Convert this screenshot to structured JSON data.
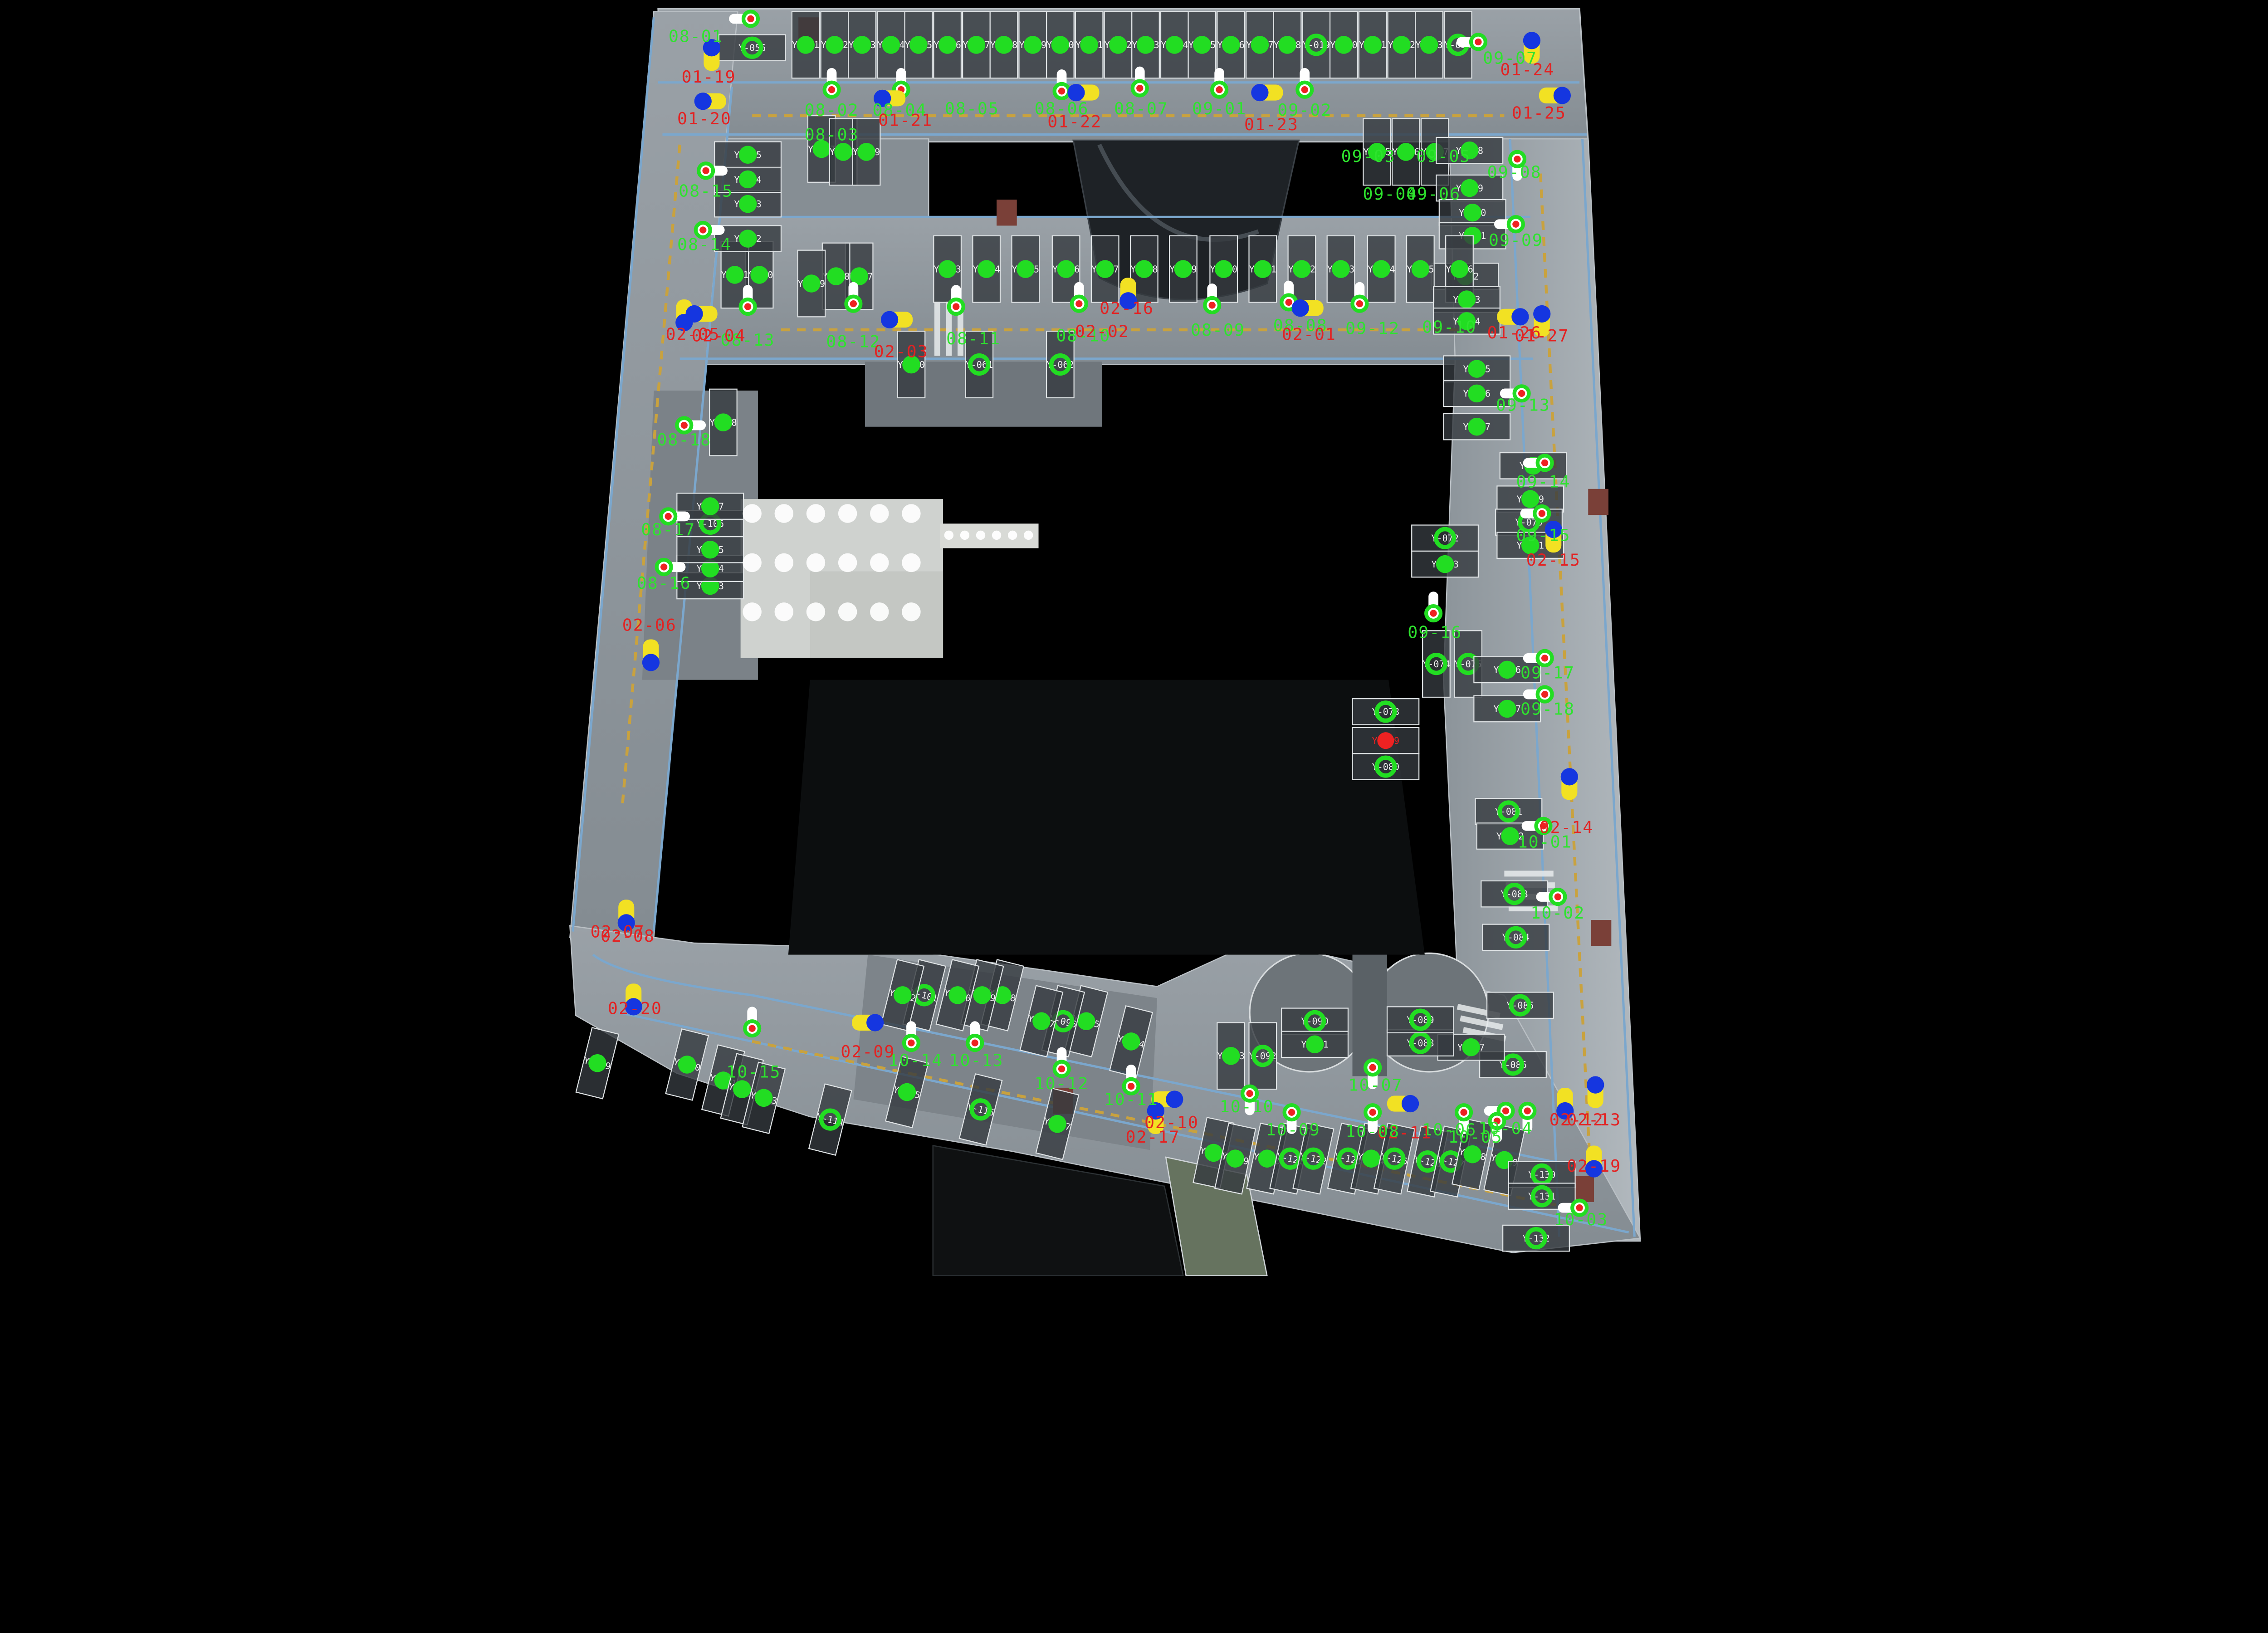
{
  "meta": {
    "view": "parking-garage-pointcloud-floorplan",
    "background": "#000000"
  },
  "colors": {
    "floor": "#8d959b",
    "floor_light": "#b5bcc1",
    "stall_fill": "#343a3f",
    "stall_stroke": "#dfe3e5",
    "corridor_line": "#7ba7cd",
    "lane_dash": "#c9a23e",
    "vacant_marker": "#22dd22",
    "occupied_marker": "#ee2222",
    "camera_ring": "#22dd22",
    "camera_center": "#ee2222",
    "camera_body": "#ffffff",
    "vehicle_yellow": "#f2e123",
    "vehicle_blue": "#1536e0",
    "zone_green": "#2ee32e",
    "zone_red": "#e32222",
    "stall_text": "#f2f2f2",
    "lobby": "#cfd2cf",
    "ramp_green": "#6d7a68",
    "patch_red": "#7a4038"
  },
  "zone_labels": [
    [
      "08-01",
      481,
      29,
      "g"
    ],
    [
      "01-19",
      490,
      57,
      "r"
    ],
    [
      "01-20",
      487,
      86,
      "r"
    ],
    [
      "08-02",
      575,
      80,
      "g"
    ],
    [
      "08-03",
      575,
      97,
      "g"
    ],
    [
      "08-04",
      622,
      80,
      "g"
    ],
    [
      "01-21",
      626,
      87,
      "r"
    ],
    [
      "08-05",
      672,
      79,
      "g"
    ],
    [
      "08-06",
      734,
      79,
      "g"
    ],
    [
      "01-22",
      743,
      88,
      "r"
    ],
    [
      "08-07",
      789,
      79,
      "g"
    ],
    [
      "09-01",
      843,
      79,
      "g"
    ],
    [
      "01-23",
      879,
      90,
      "r"
    ],
    [
      "09-02",
      902,
      80,
      "g"
    ],
    [
      "09-03",
      946,
      112,
      "g"
    ],
    [
      "09-05",
      998,
      112,
      "g"
    ],
    [
      "09-04",
      961,
      138,
      "g"
    ],
    [
      "09-06",
      991,
      138,
      "g"
    ],
    [
      "09-07",
      1044,
      44,
      "g"
    ],
    [
      "01-24",
      1056,
      52,
      "r"
    ],
    [
      "01-25",
      1064,
      82,
      "r"
    ],
    [
      "09-08",
      1047,
      123,
      "g"
    ],
    [
      "09-09",
      1048,
      170,
      "g"
    ],
    [
      "01-26",
      1047,
      234,
      "r"
    ],
    [
      "01-27",
      1066,
      236,
      "r"
    ],
    [
      "09-10",
      1002,
      230,
      "g"
    ],
    [
      "09-12",
      949,
      231,
      "g"
    ],
    [
      "09-13",
      1053,
      284,
      "g"
    ],
    [
      "09-14",
      1067,
      337,
      "g"
    ],
    [
      "09-15",
      1067,
      374,
      "g"
    ],
    [
      "02-15",
      1074,
      391,
      "r"
    ],
    [
      "09-16",
      992,
      441,
      "g"
    ],
    [
      "09-17",
      1070,
      469,
      "g"
    ],
    [
      "09-18",
      1070,
      494,
      "g"
    ],
    [
      "02-14",
      1083,
      576,
      "r"
    ],
    [
      "10-01",
      1068,
      586,
      "g"
    ],
    [
      "10-02",
      1077,
      635,
      "g"
    ],
    [
      "02-12",
      1090,
      778,
      "r"
    ],
    [
      "02-13",
      1102,
      778,
      "r"
    ],
    [
      "02-19",
      1102,
      810,
      "r"
    ],
    [
      "10-03",
      1093,
      847,
      "g"
    ],
    [
      "10-04",
      1041,
      784,
      "g"
    ],
    [
      "10-05",
      1020,
      790,
      "g"
    ],
    [
      "10-06",
      1002,
      785,
      "g"
    ],
    [
      "02-11",
      971,
      787,
      "r"
    ],
    [
      "10-08",
      949,
      786,
      "g"
    ],
    [
      "10-09",
      894,
      785,
      "g"
    ],
    [
      "10-10",
      862,
      769,
      "g"
    ],
    [
      "10-07",
      951,
      754,
      "g"
    ],
    [
      "10-11",
      782,
      764,
      "g"
    ],
    [
      "10-12",
      734,
      753,
      "g"
    ],
    [
      "02-10",
      810,
      780,
      "r"
    ],
    [
      "02-17",
      797,
      790,
      "r"
    ],
    [
      "10-13",
      675,
      737,
      "g"
    ],
    [
      "10-14",
      633,
      737,
      "g"
    ],
    [
      "02-09",
      600,
      731,
      "r"
    ],
    [
      "10-15",
      521,
      745,
      "g"
    ],
    [
      "02-07",
      427,
      648,
      "r"
    ],
    [
      "02-08",
      434,
      651,
      "r"
    ],
    [
      "02-20",
      439,
      701,
      "r"
    ],
    [
      "02-06",
      449,
      436,
      "r"
    ],
    [
      "08-16",
      459,
      407,
      "g"
    ],
    [
      "08-17",
      462,
      370,
      "g"
    ],
    [
      "08-18",
      473,
      308,
      "g"
    ],
    [
      "08-14",
      487,
      173,
      "g"
    ],
    [
      "08-15",
      488,
      136,
      "g"
    ],
    [
      "08-13",
      517,
      239,
      "g"
    ],
    [
      "02-05",
      479,
      235,
      "r"
    ],
    [
      "02-04",
      497,
      236,
      "r"
    ],
    [
      "08-12",
      590,
      240,
      "g"
    ],
    [
      "02-03",
      623,
      247,
      "r"
    ],
    [
      "08-11",
      673,
      238,
      "g"
    ],
    [
      "08-10",
      749,
      236,
      "g"
    ],
    [
      "02-02",
      762,
      233,
      "r"
    ],
    [
      "02-16",
      779,
      217,
      "r"
    ],
    [
      "08-09",
      842,
      232,
      "g"
    ],
    [
      "08-08",
      899,
      229,
      "g"
    ],
    [
      "02-01",
      905,
      235,
      "r"
    ]
  ],
  "stalls": [
    [
      "Y-001",
      557,
      31,
      "v",
      "d",
      0
    ],
    [
      "Y-002",
      577,
      31,
      "v",
      "d",
      0
    ],
    [
      "Y-003",
      596,
      31,
      "v",
      "d",
      0
    ],
    [
      "Y-004",
      616,
      31,
      "v",
      "d",
      0
    ],
    [
      "Y-005",
      635,
      31,
      "v",
      "d",
      0
    ],
    [
      "Y-006",
      655,
      31,
      "v",
      "d",
      0
    ],
    [
      "Y-007",
      675,
      31,
      "v",
      "d",
      0
    ],
    [
      "Y-008",
      694,
      31,
      "v",
      "d",
      0
    ],
    [
      "Y-009",
      714,
      31,
      "v",
      "d",
      0
    ],
    [
      "Y-010",
      733,
      31,
      "v",
      "d",
      0
    ],
    [
      "Y-011",
      753,
      31,
      "v",
      "d",
      0
    ],
    [
      "Y-012",
      773,
      31,
      "v",
      "d",
      0
    ],
    [
      "Y-013",
      792,
      31,
      "v",
      "d",
      0
    ],
    [
      "Y-014",
      812,
      31,
      "v",
      "d",
      0
    ],
    [
      "Y-015",
      831,
      31,
      "v",
      "d",
      0
    ],
    [
      "Y-016",
      851,
      31,
      "v",
      "d",
      0
    ],
    [
      "Y-017",
      871,
      31,
      "v",
      "d",
      0
    ],
    [
      "Y-018",
      890,
      31,
      "v",
      "d",
      0
    ],
    [
      "Y-019",
      910,
      31,
      "v",
      "r",
      0
    ],
    [
      "Y-020",
      929,
      31,
      "v",
      "d",
      0
    ],
    [
      "Y-021",
      949,
      31,
      "v",
      "d",
      0
    ],
    [
      "Y-022",
      969,
      31,
      "v",
      "d",
      0
    ],
    [
      "Y-023",
      988,
      31,
      "v",
      "d",
      0
    ],
    [
      "Y-024",
      1008,
      31,
      "v",
      "r",
      0
    ],
    [
      "Y-025",
      952,
      105,
      "v",
      "d",
      0
    ],
    [
      "Y-026",
      972,
      105,
      "v",
      "d",
      0
    ],
    [
      "Y-027",
      992,
      105,
      "v",
      "d",
      0
    ],
    [
      "Y-028",
      1016,
      104,
      "h",
      "d",
      0
    ],
    [
      "Y-029",
      1016,
      130,
      "h",
      "d",
      0
    ],
    [
      "Y-030",
      1018,
      147,
      "h",
      "d",
      0
    ],
    [
      "Y-031",
      1018,
      163,
      "h",
      "d",
      0
    ],
    [
      "Y-032",
      1013,
      191,
      "h",
      "d",
      0
    ],
    [
      "Y-033",
      655,
      186,
      "v",
      "d",
      0
    ],
    [
      "Y-034",
      682,
      186,
      "v",
      "d",
      0
    ],
    [
      "Y-035",
      709,
      186,
      "v",
      "d",
      0
    ],
    [
      "Y-036",
      737,
      186,
      "v",
      "d",
      0
    ],
    [
      "Y-037",
      764,
      186,
      "v",
      "d",
      0
    ],
    [
      "Y-038",
      791,
      186,
      "v",
      "d",
      0
    ],
    [
      "Y-039",
      818,
      186,
      "v",
      "d",
      0
    ],
    [
      "Y-040",
      846,
      186,
      "v",
      "d",
      0
    ],
    [
      "Y-041",
      873,
      186,
      "v",
      "d",
      0
    ],
    [
      "Y-042",
      900,
      186,
      "v",
      "d",
      0
    ],
    [
      "Y-043",
      927,
      186,
      "v",
      "d",
      0
    ],
    [
      "Y-044",
      955,
      186,
      "v",
      "d",
      0
    ],
    [
      "Y-045",
      982,
      186,
      "v",
      "d",
      0
    ],
    [
      "Y-046",
      1009,
      186,
      "v",
      "d",
      0
    ],
    [
      "Y-047",
      594,
      191,
      "v",
      "d",
      0
    ],
    [
      "Y-048",
      578,
      191,
      "v",
      "d",
      0
    ],
    [
      "Y-049",
      561,
      196,
      "v",
      "d",
      0
    ],
    [
      "Y-050",
      525,
      190,
      "v",
      "d",
      0
    ],
    [
      "Y-051",
      508,
      190,
      "v",
      "d",
      0
    ],
    [
      "Y-052",
      517,
      165,
      "h",
      "d",
      0
    ],
    [
      "Y-053",
      517,
      141,
      "h",
      "d",
      0
    ],
    [
      "Y-054",
      517,
      124,
      "h",
      "d",
      0
    ],
    [
      "Y-055",
      517,
      107,
      "h",
      "d",
      0
    ],
    [
      "Y-056",
      520,
      33,
      "h",
      "r",
      0
    ],
    [
      "Y-057",
      568,
      103,
      "v",
      "d",
      0
    ],
    [
      "Y-058",
      583,
      105,
      "v",
      "d",
      0
    ],
    [
      "Y-059",
      599,
      105,
      "v",
      "d",
      0
    ],
    [
      "Y-060",
      630,
      252,
      "v",
      "d",
      0
    ],
    [
      "Y-061",
      677,
      252,
      "v",
      "r",
      0
    ],
    [
      "Y-062",
      733,
      252,
      "v",
      "r",
      0
    ],
    [
      "Y-063",
      1014,
      207,
      "h",
      "d",
      0
    ],
    [
      "Y-064",
      1014,
      222,
      "h",
      "d",
      0
    ],
    [
      "Y-065",
      1021,
      255,
      "h",
      "d",
      0
    ],
    [
      "Y-066",
      1021,
      272,
      "h",
      "d",
      0
    ],
    [
      "Y-067",
      1021,
      295,
      "h",
      "d",
      0
    ],
    [
      "Y-068",
      1060,
      322,
      "h",
      "d",
      0
    ],
    [
      "Y-069",
      1058,
      345,
      "h",
      "d",
      0
    ],
    [
      "Y-070",
      1057,
      361,
      "h",
      "r",
      0
    ],
    [
      "Y-071",
      1058,
      377,
      "h",
      "d",
      0
    ],
    [
      "Y-072",
      999,
      372,
      "h",
      "r",
      0
    ],
    [
      "Y-073",
      999,
      390,
      "h",
      "d",
      0
    ],
    [
      "Y-074",
      993,
      459,
      "v",
      "r",
      0
    ],
    [
      "Y-075",
      1015,
      459,
      "v",
      "r",
      0
    ],
    [
      "Y-076",
      1042,
      463,
      "h",
      "d",
      0
    ],
    [
      "Y-077",
      1042,
      490,
      "h",
      "d",
      0
    ],
    [
      "Y-078",
      958,
      492,
      "h",
      "r",
      0
    ],
    [
      "Y-079",
      958,
      512,
      "h",
      "x",
      0
    ],
    [
      "Y-080",
      958,
      530,
      "h",
      "r",
      0
    ],
    [
      "Y-081",
      1043,
      561,
      "h",
      "r",
      0
    ],
    [
      "Y-082",
      1044,
      578,
      "h",
      "d",
      0
    ],
    [
      "Y-083",
      1047,
      618,
      "h",
      "r",
      0
    ],
    [
      "Y-084",
      1048,
      648,
      "h",
      "r",
      0
    ],
    [
      "Y-085",
      1051,
      695,
      "h",
      "r",
      0
    ],
    [
      "Y-086",
      1046,
      736,
      "h",
      "r",
      0
    ],
    [
      "Y-087",
      1017,
      724,
      "h",
      "d",
      0
    ],
    [
      "Y-088",
      982,
      721,
      "h",
      "r",
      0
    ],
    [
      "Y-089",
      982,
      705,
      "h",
      "r",
      0
    ],
    [
      "Y-090",
      909,
      706,
      "h",
      "r",
      0
    ],
    [
      "Y-091",
      909,
      722,
      "h",
      "d",
      0
    ],
    [
      "Y-092",
      873,
      730,
      "v",
      "r",
      0
    ],
    [
      "Y-093",
      851,
      730,
      "v",
      "d",
      0
    ],
    [
      "Y-094",
      782,
      720,
      "v",
      "d",
      14
    ],
    [
      "Y-095",
      751,
      706,
      "v",
      "d",
      14
    ],
    [
      "Y-096",
      735,
      706,
      "v",
      "r",
      14
    ],
    [
      "Y-097",
      720,
      706,
      "v",
      "d",
      14
    ],
    [
      "Y-098",
      693,
      688,
      "v",
      "d",
      14
    ],
    [
      "Y-099",
      679,
      688,
      "v",
      "d",
      14
    ],
    [
      "Y-100",
      662,
      688,
      "v",
      "d",
      14
    ],
    [
      "Y-101",
      639,
      688,
      "v",
      "r",
      14
    ],
    [
      "Y-102",
      624,
      688,
      "v",
      "d",
      14
    ],
    [
      "Y-103",
      491,
      405,
      "h",
      "d",
      0
    ],
    [
      "Y-104",
      491,
      393,
      "h",
      "d",
      0
    ],
    [
      "Y-105",
      491,
      380,
      "h",
      "d",
      0
    ],
    [
      "Y-106",
      491,
      362,
      "h",
      "r",
      0
    ],
    [
      "Y-107",
      491,
      350,
      "h",
      "d",
      0
    ],
    [
      "Y-108",
      500,
      292,
      "v",
      "d",
      0
    ],
    [
      "Y-109",
      413,
      735,
      "v",
      "d",
      14
    ],
    [
      "Y-110",
      475,
      736,
      "v",
      "d",
      14
    ],
    [
      "Y-111",
      500,
      747,
      "v",
      "d",
      14
    ],
    [
      "Y-112",
      513,
      753,
      "v",
      "d",
      14
    ],
    [
      "Y-113",
      528,
      759,
      "v",
      "d",
      14
    ],
    [
      "Y-114",
      574,
      774,
      "v",
      "r",
      14
    ],
    [
      "Y-115",
      627,
      755,
      "v",
      "d",
      14
    ],
    [
      "Y-116",
      678,
      767,
      "v",
      "r",
      14
    ],
    [
      "Y-117",
      731,
      777,
      "v",
      "d",
      14
    ],
    [
      "Y-118",
      839,
      797,
      "v",
      "d",
      12
    ],
    [
      "Y-119",
      854,
      801,
      "v",
      "d",
      12
    ],
    [
      "Y-120",
      876,
      801,
      "v",
      "d",
      12
    ],
    [
      "Y-121",
      892,
      801,
      "v",
      "r",
      12
    ],
    [
      "Y-122",
      908,
      801,
      "v",
      "r",
      12
    ],
    [
      "Y-123",
      932,
      801,
      "v",
      "r",
      12
    ],
    [
      "Y-124",
      948,
      801,
      "v",
      "d",
      12
    ],
    [
      "Y-125",
      964,
      801,
      "v",
      "r",
      12
    ],
    [
      "Y-126",
      987,
      803,
      "v",
      "r",
      12
    ],
    [
      "Y-127",
      1003,
      803,
      "v",
      "r",
      12
    ],
    [
      "Y-128",
      1018,
      798,
      "v",
      "d",
      12
    ],
    [
      "Y-129",
      1040,
      802,
      "v",
      "d",
      12
    ],
    [
      "Y-130",
      1066,
      812,
      "h",
      "r",
      0
    ],
    [
      "Y-131",
      1066,
      827,
      "h",
      "r",
      0
    ],
    [
      "Y-132",
      1062,
      856,
      "h",
      "r",
      0
    ]
  ],
  "cameras": [
    [
      575,
      62,
      0
    ],
    [
      623,
      62,
      0
    ],
    [
      734,
      63,
      0
    ],
    [
      788,
      61,
      0
    ],
    [
      843,
      62,
      0
    ],
    [
      902,
      62,
      0
    ],
    [
      1022,
      29,
      270
    ],
    [
      519,
      13,
      270
    ],
    [
      590,
      210,
      0
    ],
    [
      661,
      212,
      0
    ],
    [
      746,
      210,
      0
    ],
    [
      838,
      211,
      0
    ],
    [
      891,
      209,
      0
    ],
    [
      940,
      210,
      0
    ],
    [
      517,
      212,
      0
    ],
    [
      1049,
      110,
      180
    ],
    [
      1048,
      155,
      270
    ],
    [
      1052,
      272,
      270
    ],
    [
      1068,
      320,
      270
    ],
    [
      1066,
      355,
      270
    ],
    [
      991,
      424,
      0
    ],
    [
      1068,
      455,
      270
    ],
    [
      1068,
      480,
      270
    ],
    [
      1067,
      571,
      270
    ],
    [
      1077,
      620,
      270
    ],
    [
      1041,
      768,
      270
    ],
    [
      1092,
      835,
      270
    ],
    [
      473,
      294,
      90
    ],
    [
      462,
      357,
      90
    ],
    [
      459,
      392,
      90
    ],
    [
      488,
      118,
      90
    ],
    [
      486,
      159,
      90
    ],
    [
      520,
      711,
      0
    ],
    [
      630,
      721,
      0
    ],
    [
      674,
      721,
      0
    ],
    [
      734,
      739,
      0
    ],
    [
      782,
      751,
      0
    ],
    [
      864,
      756,
      180
    ],
    [
      893,
      769,
      180
    ],
    [
      949,
      738,
      180
    ],
    [
      949,
      769,
      180
    ],
    [
      1012,
      769,
      180
    ],
    [
      1035,
      775,
      180
    ],
    [
      1056,
      768,
      180
    ]
  ],
  "vehicles": [
    [
      492,
      40,
      "v"
    ],
    [
      493,
      70,
      "h"
    ],
    [
      617,
      68,
      "h"
    ],
    [
      751,
      64,
      "h"
    ],
    [
      878,
      64,
      "h"
    ],
    [
      1059,
      35,
      "v"
    ],
    [
      1072,
      66,
      "h2"
    ],
    [
      473,
      215,
      "v2"
    ],
    [
      487,
      217,
      "h"
    ],
    [
      622,
      221,
      "h"
    ],
    [
      780,
      200,
      "v2"
    ],
    [
      906,
      213,
      "h"
    ],
    [
      1043,
      219,
      "h2"
    ],
    [
      1066,
      224,
      "v"
    ],
    [
      1074,
      373,
      "v"
    ],
    [
      1085,
      544,
      "v"
    ],
    [
      433,
      630,
      "v2"
    ],
    [
      438,
      688,
      "v2"
    ],
    [
      450,
      450,
      "v2"
    ],
    [
      597,
      707,
      "h2"
    ],
    [
      967,
      763,
      "h2"
    ],
    [
      804,
      760,
      "h2"
    ],
    [
      799,
      775,
      "v"
    ],
    [
      1082,
      760,
      "v2"
    ],
    [
      1103,
      757,
      "v"
    ],
    [
      1102,
      800,
      "v2"
    ]
  ],
  "red_patches": [
    [
      1105,
      347
    ],
    [
      1107,
      645
    ],
    [
      1095,
      822
    ],
    [
      735,
      761
    ],
    [
      696,
      147
    ],
    [
      559,
      21
    ]
  ]
}
